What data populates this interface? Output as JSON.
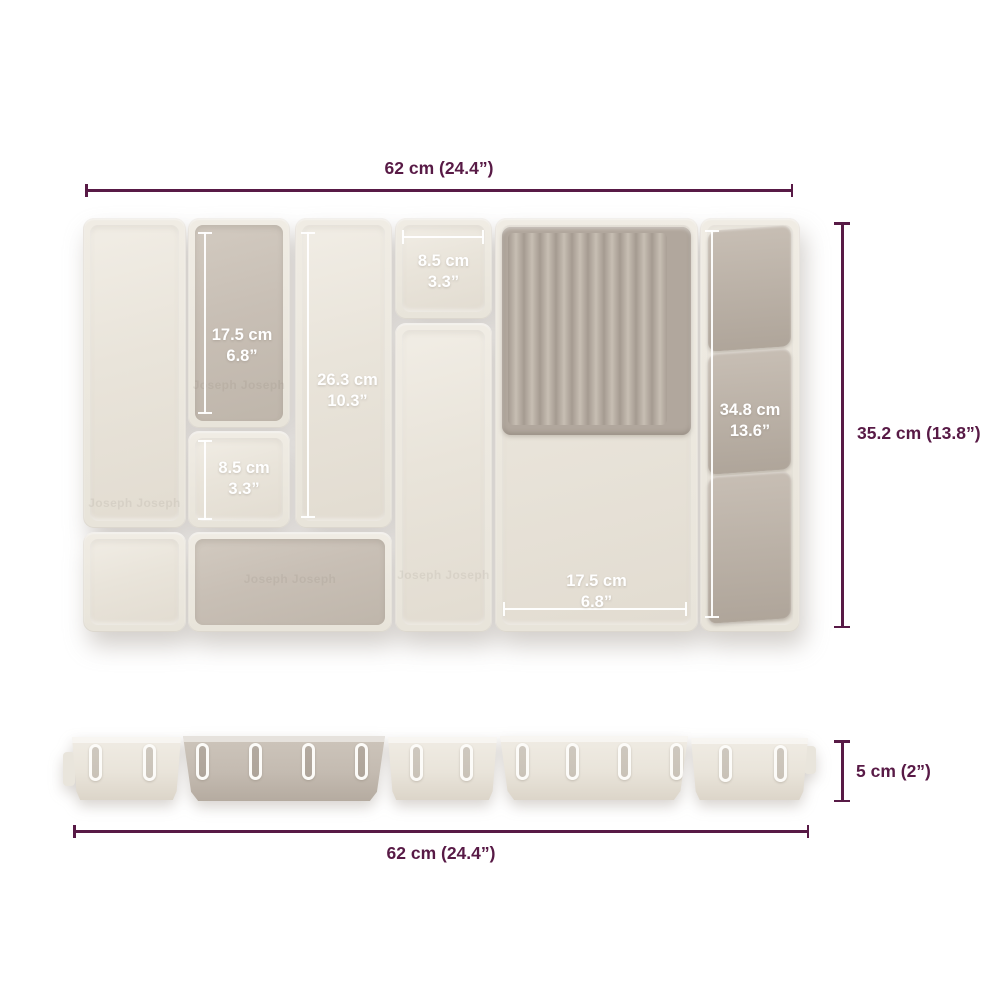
{
  "product": {
    "type": "drawer organizer dimension diagram",
    "embossed_logo": "Joseph Joseph"
  },
  "colors": {
    "accent": "#581a46",
    "cream": "#ebe7de",
    "taupe": "#c6bdb3",
    "background": "#ffffff",
    "measure_line": "#ffffff"
  },
  "overall_dimensions": {
    "top_width": "62 cm (24.4”)",
    "right_height": "35.2 cm (13.8”)",
    "bottom_width": "62 cm (24.4”)",
    "side_height": "5 cm (2”)"
  },
  "compartment_labels": {
    "left_tall": {
      "cm": "17.5 cm",
      "inch": "6.8”"
    },
    "left_small": {
      "cm": "8.5 cm",
      "inch": "3.3”"
    },
    "center_tall": {
      "cm": "26.3 cm",
      "inch": "10.3”"
    },
    "top_small": {
      "cm": "8.5 cm",
      "inch": "3.3”"
    },
    "main_bottom": {
      "cm": "17.5 cm",
      "inch": "6.8”"
    },
    "knife_block": {
      "cm": "34.8 cm",
      "inch": "13.6”"
    }
  }
}
